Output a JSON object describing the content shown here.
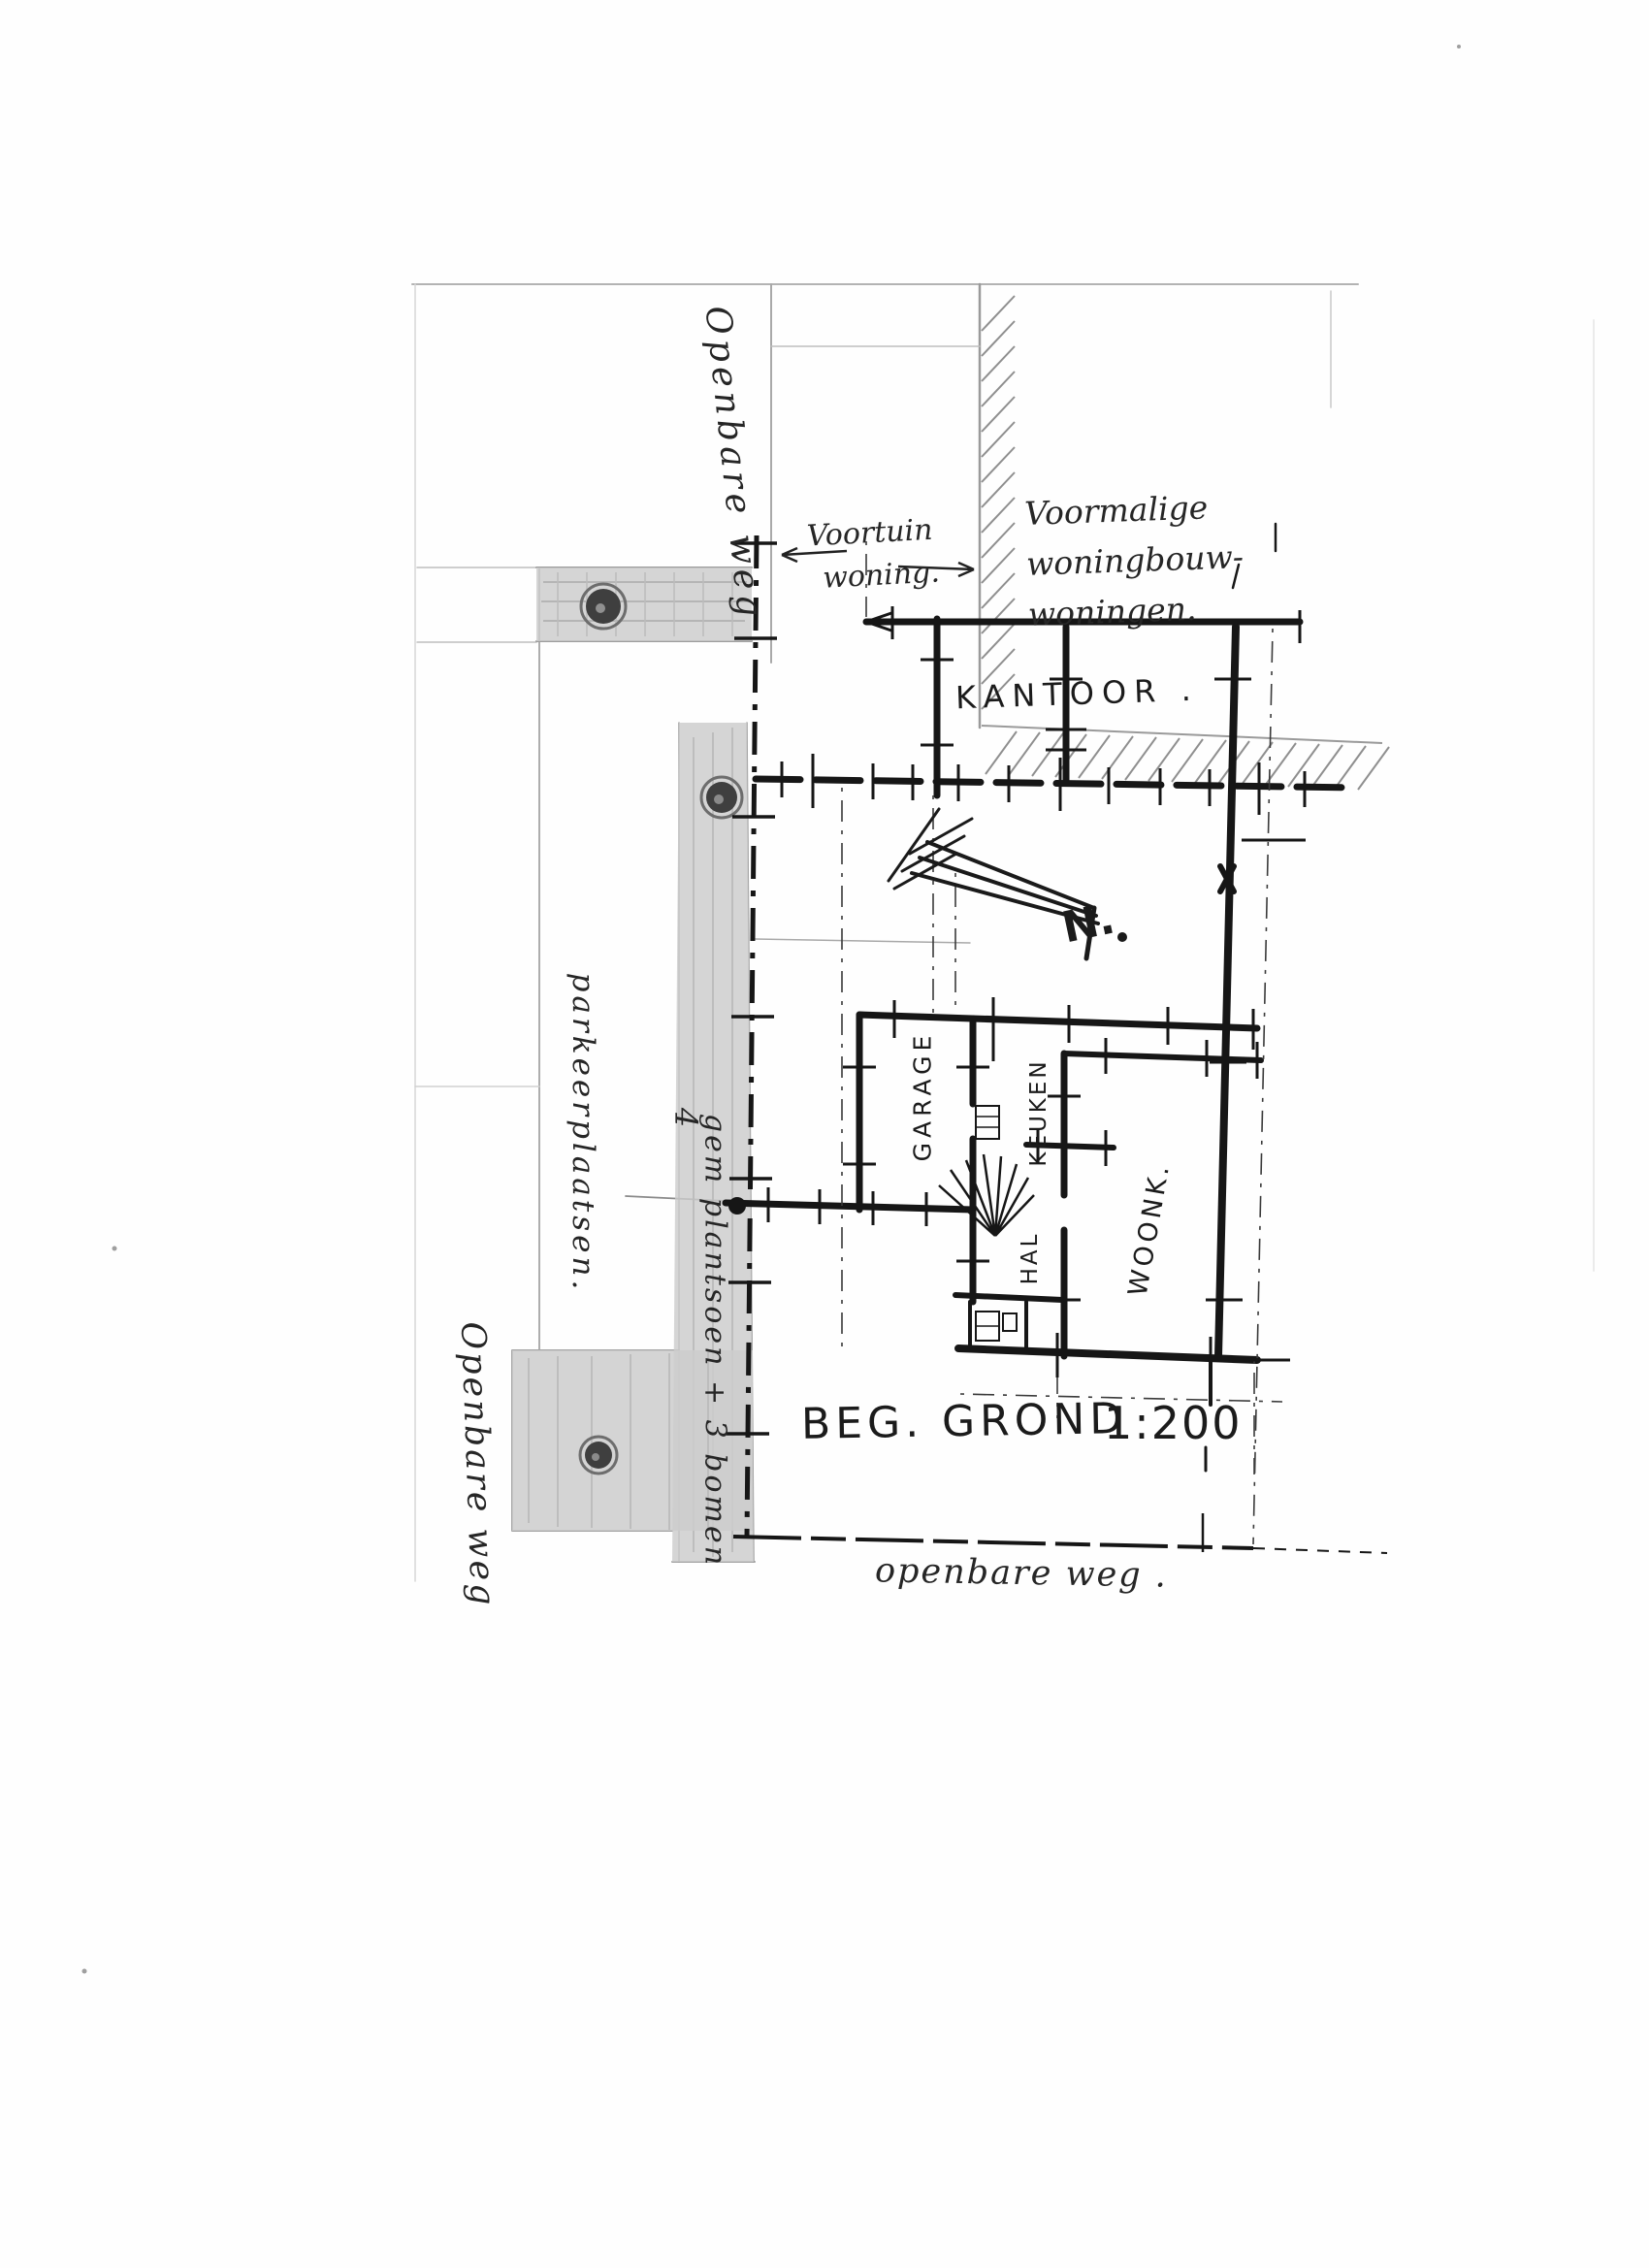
{
  "sheet": {
    "drawing_title": "BEG. GROND",
    "scale": "1:200"
  },
  "annotations": {
    "openbare_weg_top": "Openbare weg",
    "voortuin_line1": "Voortuin",
    "voortuin_line2": "woning.",
    "voormalige_line1": "Voormalige",
    "voormalige_line2": "woningbouw-",
    "voormalige_line3": "woningen.",
    "parkeerplaatsen": "parkeerplaatsen.",
    "plantsoen_marker": "4",
    "plantsoen": "gem plantsoen + 3 bomen",
    "openbare_weg_left": "Openbare weg",
    "openbare_weg_bottom": "openbare weg ."
  },
  "rooms": {
    "kantoor": "KANTOOR .",
    "garage": "GARAGE",
    "keuken": "KEUKEN",
    "hal": "HAL",
    "woonkamer": "WOONK.",
    "north_mark": "N."
  },
  "symbols": {
    "tree_count": 3,
    "north_arrow": "arrow-with-feathers-pointing-to-N"
  },
  "colors": {
    "ink": "#161616",
    "pencil": "#a8a8a8",
    "shading": "#cccccc",
    "tree": "#3f3f3f",
    "paper": "#fefefe"
  }
}
